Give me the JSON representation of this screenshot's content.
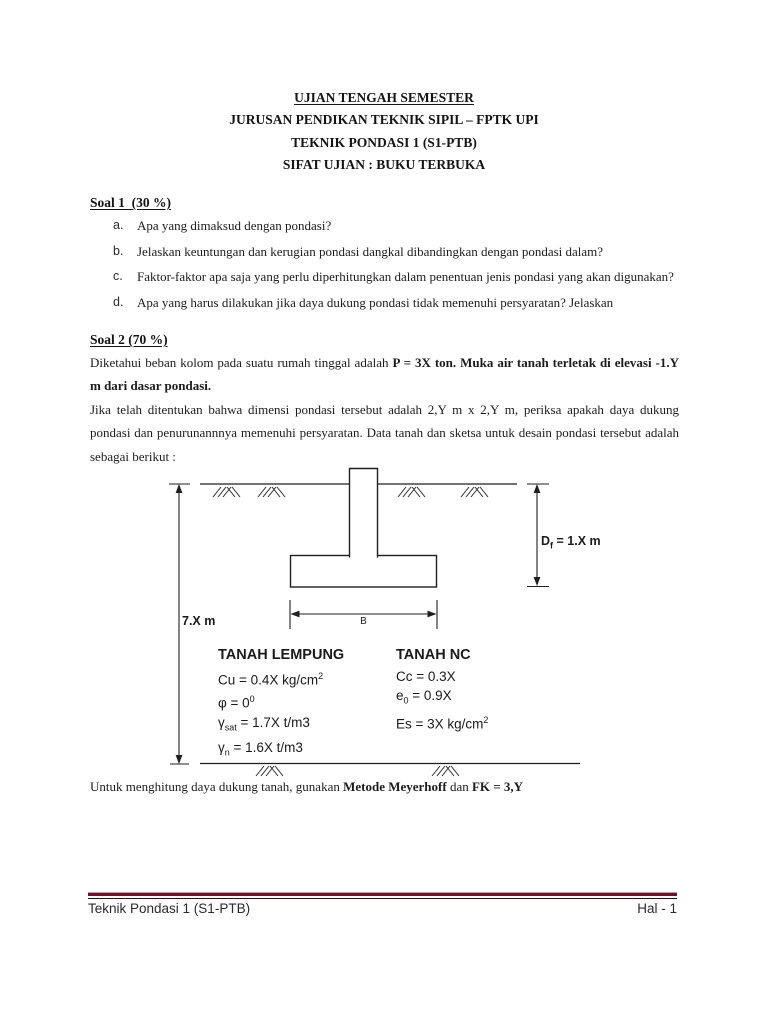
{
  "header": {
    "line1": "UJIAN TENGAH SEMESTER",
    "line2": "JURUSAN PENDIKAN TEKNIK SIPIL – FPTK UPI",
    "line3": "TEKNIK PONDASI 1 (S1-PTB)",
    "line4": "SIFAT UJIAN : BUKU TERBUKA"
  },
  "soal1": {
    "heading": "Soal 1  (30 %)",
    "items": [
      {
        "letter": "a.",
        "text": "Apa yang dimaksud dengan pondasi?"
      },
      {
        "letter": "b.",
        "text": "Jelaskan keuntungan dan kerugian pondasi dangkal dibandingkan dengan pondasi dalam?"
      },
      {
        "letter": "c.",
        "text": "Faktor-faktor apa saja yang perlu diperhitungkan dalam penentuan jenis pondasi yang akan digunakan?"
      },
      {
        "letter": "d.",
        "text": "Apa yang harus dilakukan jika daya dukung pondasi tidak memenuhi persyaratan? Jelaskan"
      }
    ]
  },
  "soal2": {
    "heading": "Soal 2 (70 %)",
    "p1_normal": "Diketahui beban kolom pada suatu rumah tinggal adalah ",
    "p1_bold": "P = 3X ton. Muka air tanah terletak di elevasi -1.Y m dari dasar pondasi.",
    "p2": "Jika telah ditentukan bahwa dimensi pondasi tersebut adalah 2,Y m x 2,Y m, periksa apakah daya dukung pondasi dan penurunannnya memenuhi persyaratan. Data tanah dan sketsa untuk desain pondasi tersebut adalah sebagai berikut :",
    "closing_normal": "Untuk menghitung daya dukung tanah, gunakan ",
    "closing_bold1": "Metode Meyerhoff",
    "closing_mid": " dan ",
    "closing_bold2": "FK = 3,Y"
  },
  "diagram": {
    "dim_left": "7.X m",
    "dim_right_sym": "D",
    "dim_right_sub": "f",
    "dim_right_rest": " = 1.X m",
    "dim_b": "B",
    "soil_left": {
      "title": "TANAH LEMPUNG",
      "cu_main": "Cu = 0.4X kg/cm",
      "cu_sup": "2",
      "phi_main": "φ = 0",
      "phi_sup": "0",
      "gsat_sym": "γ",
      "gsat_sub": "sat",
      "gsat_rest": " = 1.7X t/m3",
      "gn_sym": "γ",
      "gn_sub": "n",
      "gn_rest": " = 1.6X t/m3"
    },
    "soil_right": {
      "title": "TANAH NC",
      "cc": "Cc = 0.3X",
      "e_sym": "e",
      "e_sub": "0",
      "e_rest": " = 0.9X",
      "es_main": "Es = 3X kg/cm",
      "es_sup": "2"
    }
  },
  "footer": {
    "left": "Teknik Pondasi 1 (S1-PTB)",
    "right": "Hal - 1",
    "rule_color": "#67172a"
  }
}
